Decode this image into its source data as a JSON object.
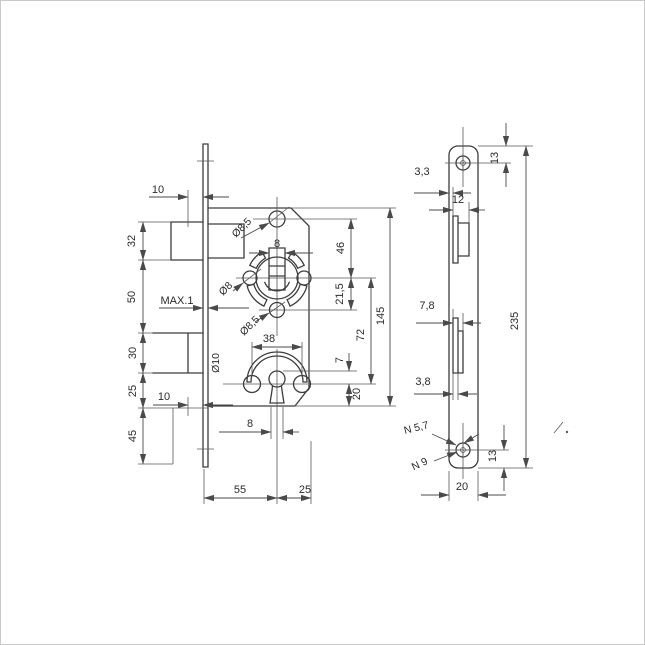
{
  "drawing": {
    "type": "technical-drawing",
    "subject": "mortise-lock",
    "background": "#ffffff",
    "line_color": "#3d3d3d",
    "dim_color": "#4a4a4a",
    "front_view": {
      "dims": {
        "ten_top": "10",
        "thirty_two": "32",
        "fifty": "50",
        "max_one": "MAX.1",
        "thirty": "30",
        "twenty_five_left": "25",
        "ten_bottom": "10",
        "forty_five": "45",
        "fifty_five": "55",
        "twenty_five_bottom": "25",
        "dia85_top": "Ø8,5",
        "eight_spindle": "8",
        "dia8": "Ø8",
        "dia85_mid": "Ø8,5",
        "forty_six": "46",
        "twenty_one_five": "21,5",
        "seventy_two": "72",
        "one_forty_five": "145",
        "thirty_eight": "38",
        "dia10": "Ø10",
        "seven": "7",
        "twenty_front": "20",
        "eight_keyhole": "8"
      }
    },
    "side_view": {
      "dims": {
        "thirteen_top": "13",
        "three_three": "3,3",
        "twelve": "12",
        "seven_eight": "7,8",
        "three_eight": "3,8",
        "n_five_seven": "N 5,7",
        "n_nine": "N 9",
        "thirteen_bottom": "13",
        "twenty_side": "20",
        "two_thirty_five": "235"
      }
    }
  }
}
